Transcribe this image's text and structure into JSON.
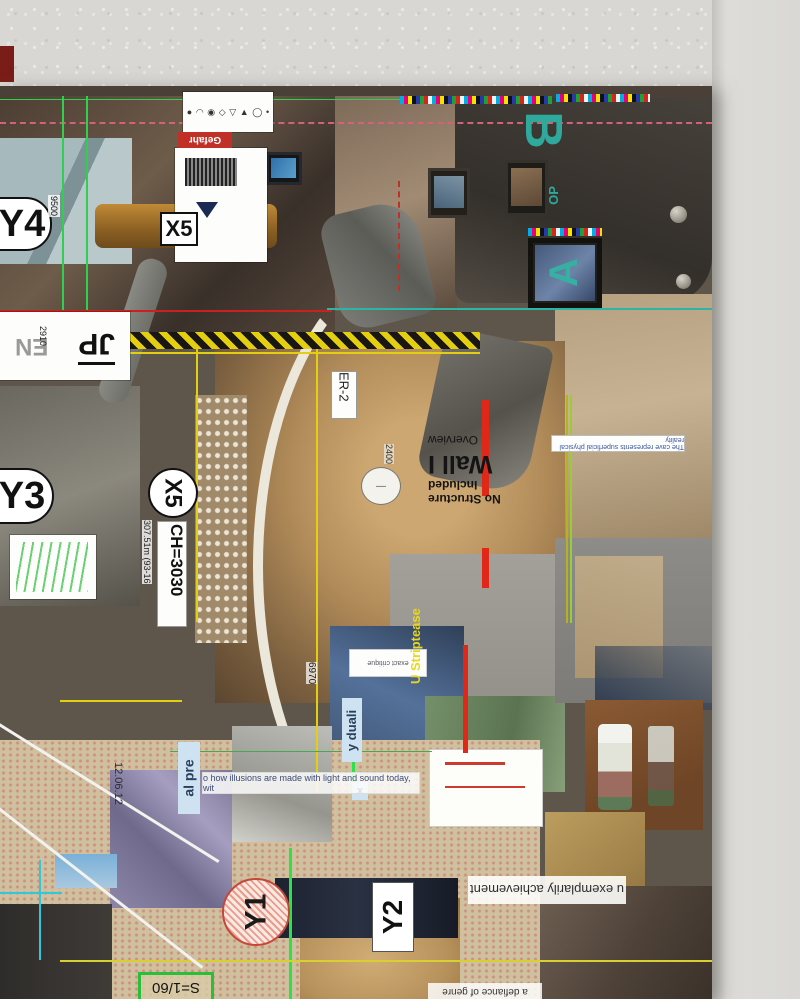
{
  "scene": {
    "description": "collage poster pinned on textured wall",
    "colors": {
      "wall": "#d8d7d3",
      "cad_yellow": "#e3cf10",
      "cad_green": "#2fcf4f",
      "cad_red": "#cc2020",
      "cad_teal": "#2ab5a5",
      "cad_cyan": "#30c8d8",
      "accent_teal_letter": "#2ea99c",
      "danger_red": "#c03028",
      "strip_blue": "#cfe2f1"
    }
  },
  "poster": {
    "grid_labels": {
      "y4": "Y4",
      "x5_top": "X5",
      "y3": "Y3",
      "x5_mid": "X5",
      "y1": "Y1",
      "y2": "Y2"
    },
    "dims": {
      "d9500": "9500",
      "d2910": "2910",
      "d2400": "2400",
      "d6970": "6970",
      "ch": "CH=3030",
      "chm": "307.51m (93-16",
      "er2": "ER-2",
      "scale": "S=1/60",
      "date": "12.06.12"
    },
    "letters": {
      "jp": "JP",
      "en": "EN",
      "b": "B",
      "a": "A",
      "op": "OP"
    },
    "phrases": {
      "gefahr": "Gefahr",
      "wall_title": "Wall I",
      "overview": "Overview",
      "no_structure": "No Structure Included",
      "cave": "The cave represents superficial physical reality",
      "critique": "exact critique",
      "striptease": "U Striptease",
      "duali": "y duali",
      "al_pre": "al pre",
      "x_chip": "x",
      "illusions": "o how illusions are made with light and sound today, wit",
      "exemplarily": "u exemplarily achievement",
      "defiance": "a defiance of genre"
    },
    "toolbar_icons": {
      "dot": "●",
      "cloud": "◠",
      "target": "◉",
      "diamond": "◇",
      "down": "▽",
      "triangle": "▲",
      "ring": "◯",
      "small_dot": "•"
    }
  }
}
